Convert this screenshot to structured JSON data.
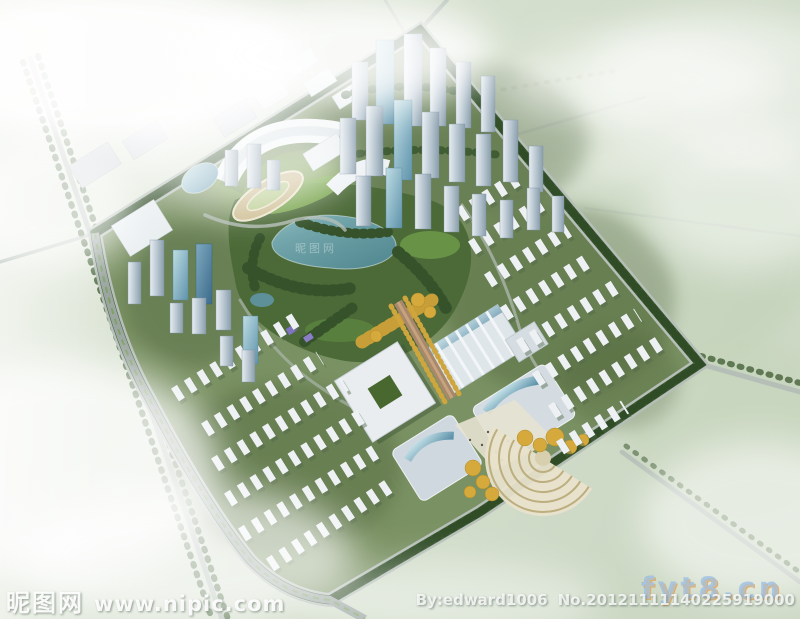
{
  "watermarks": {
    "site_name": "昵图网",
    "site_url": "www.nipic.com",
    "author": "By:edward1006",
    "serial": "No.20121111140225919000",
    "overlay_domain": "fyt8.cn",
    "lake_watermark": "昵图网"
  },
  "colors": {
    "field_green": "#d6e0cf",
    "site_green": "#7a9163",
    "park_green": "#4c6a38",
    "lake_teal": "#5d9099",
    "building_white": "#eef2f4",
    "glass_blue": "#6f9fb4",
    "golden_trees": "#cfa53d",
    "road_gray": "#9fa9a5",
    "tree_belt_green": "#3c5a30",
    "cloud_white": "#ffffff"
  }
}
